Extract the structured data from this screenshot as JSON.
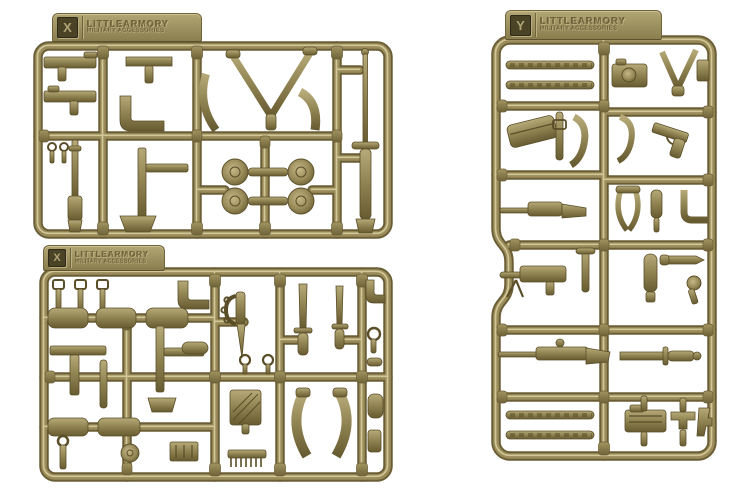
{
  "meta": {
    "description": "Product photograph of three olive-drab injection-moulded plastic model-kit sprues (runners) holding miniature military weapon and equipment parts, on a plain white background."
  },
  "palette": {
    "background": "#ffffff",
    "bar_shadow": "#6b5e36",
    "bar_mid": "#9a8d5b",
    "bar_highlight": "#d3c697",
    "part_dark": "#5a4e28",
    "part_mid": "#8d8050",
    "tab_top": "#b2a674",
    "tab_bottom": "#8a7e4f",
    "plaque_bg": "#4a4326",
    "plaque_text": "#b0a476",
    "emboss_text": "#776b41"
  },
  "sprues": {
    "a": {
      "position": "top-left",
      "tab_letter": "X",
      "brand": "LITTLEARMORY",
      "subtitle": "MILITARY ACCESSORIES",
      "contents": [
        "submachine guns",
        "pipe / bracket fittings",
        "Y-shaped sling",
        "curved magazines",
        "four drum magazines",
        "vertical rifle",
        "long sword with scabbard"
      ]
    },
    "b": {
      "position": "bottom-left",
      "tab_letter": "X",
      "brand": "LITTLEARMORY",
      "subtitle": "MILITARY ACCESSORIES",
      "contents": [
        "belt buckles and straps",
        "flat pouch pads",
        "trench knife with knuckle guard",
        "bayonets",
        "ring pins",
        "brush",
        "comb",
        "curved magazines",
        "small tools"
      ]
    },
    "c": {
      "position": "right",
      "tab_letter": "Y",
      "brand": "LITTLEARMORY",
      "subtitle": "MILITARY ACCESSORIES",
      "contents": [
        "ammunition belts",
        "magazine pouch",
        "hooks",
        "camera",
        "pistol",
        "machine gun with bipod",
        "scoped rifle",
        "bayonet",
        "gun receivers"
      ]
    }
  }
}
